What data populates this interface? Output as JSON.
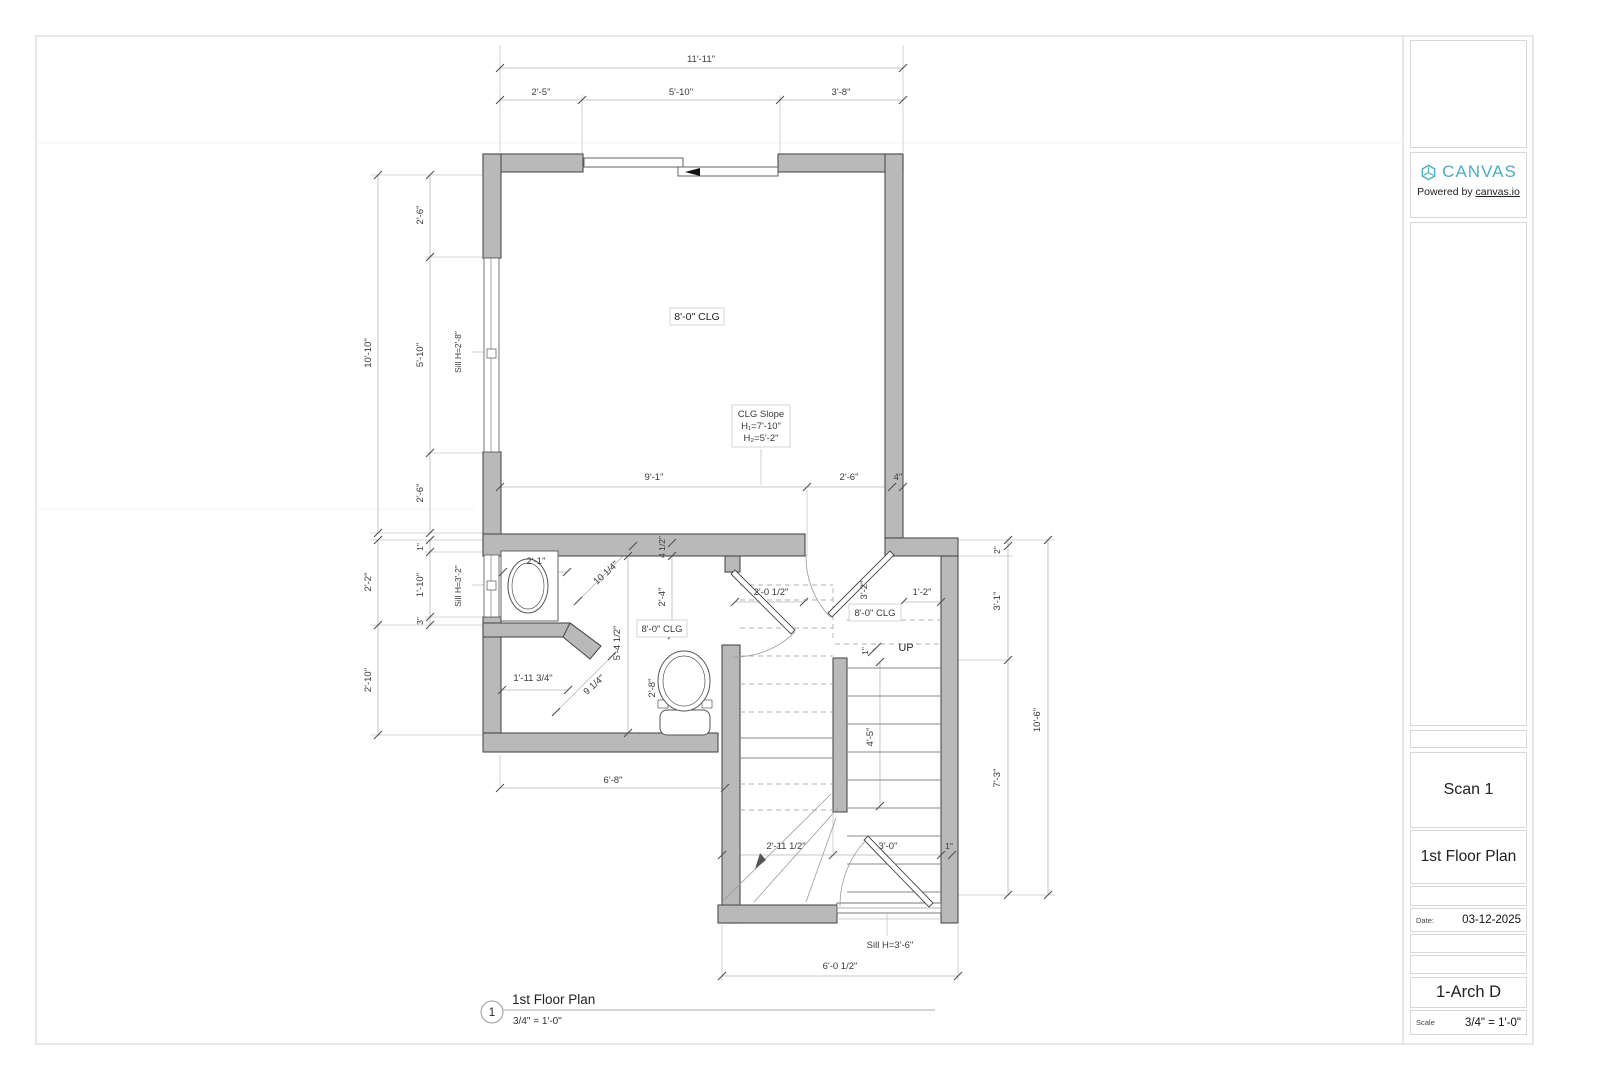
{
  "colors": {
    "brand_teal": "#4baec3",
    "wall_fill": "#b9b9b9",
    "wall_stroke": "#4d4d4d"
  },
  "title_block": {
    "brand": "CANVAS",
    "powered_prefix": "Powered by ",
    "powered_link": "canvas.io",
    "sheet_name": "Scan 1",
    "sheet_title": "1st Floor Plan",
    "date_label": "Date:",
    "date_value": "03-12-2025",
    "sheet_number": "1-Arch D",
    "scale_label": "Scale",
    "scale_value": "3/4\" = 1'-0\""
  },
  "drawing_title": {
    "number": "1",
    "title": "1st Floor Plan",
    "scale": "3/4\" = 1'-0\""
  },
  "plan": {
    "room_labels": {
      "clg_main": "8'-0\" CLG",
      "clg_bath": "8'-0\" CLG",
      "clg_hall": "8'-0\" CLG",
      "slope_1": "CLG Slope",
      "slope_2": "H₁=7'-10\"",
      "slope_3": "H₂=5'-2\"",
      "up": "UP",
      "sill_window_left_upper": "Sill H=2'-8\"",
      "sill_window_left_lower": "Sill H=3'-2\"",
      "sill_window_bottom": "Sill H=3'-6\""
    },
    "dims": {
      "top_total": "11'-11\"",
      "top_a": "2'-5\"",
      "top_b": "5'-10\"",
      "top_c": "3'-8\"",
      "left_total": "10'-10\"",
      "left_a": "2'-6\"",
      "left_b": "5'-10\"",
      "left_c": "2'-6\"",
      "mid_a": "9'-1\"",
      "mid_b": "2'-6\"",
      "mid_c": "4\"",
      "ll_total_a": "2'-2\"",
      "ll_total_b": "2'-10\"",
      "ll_a": "1\"",
      "ll_b": "1'-10\"",
      "ll_c": "3\"",
      "bath_counter": "2'-1\"",
      "bath_diag_a": "10 1/4\"",
      "bath_small": "4 1/2\"",
      "bath_v_a": "2'-4\"",
      "bath_v_b": "5'-4 1/2\"",
      "bath_w": "1'-11 3/4\"",
      "bath_diag_b": "9 1/4\"",
      "toilet_w": "2'-8\"",
      "hall_door": "2'-0 1/2\"",
      "hall_door_b": "3'-2\"",
      "hall_jamb": "1'-2\"",
      "stair_nose": "1\"",
      "stair_run": "4'-5\"",
      "right_a": "2\"",
      "right_b": "3'-1\"",
      "right_c": "7'-3\"",
      "right_total": "10'-6\"",
      "bot_right_jamb": "1\"",
      "bath_width": "6'-8\"",
      "bot_a": "2'-11 1/2\"",
      "bot_b": "3'-0\"",
      "bot_total": "6'-0 1/2\""
    }
  }
}
